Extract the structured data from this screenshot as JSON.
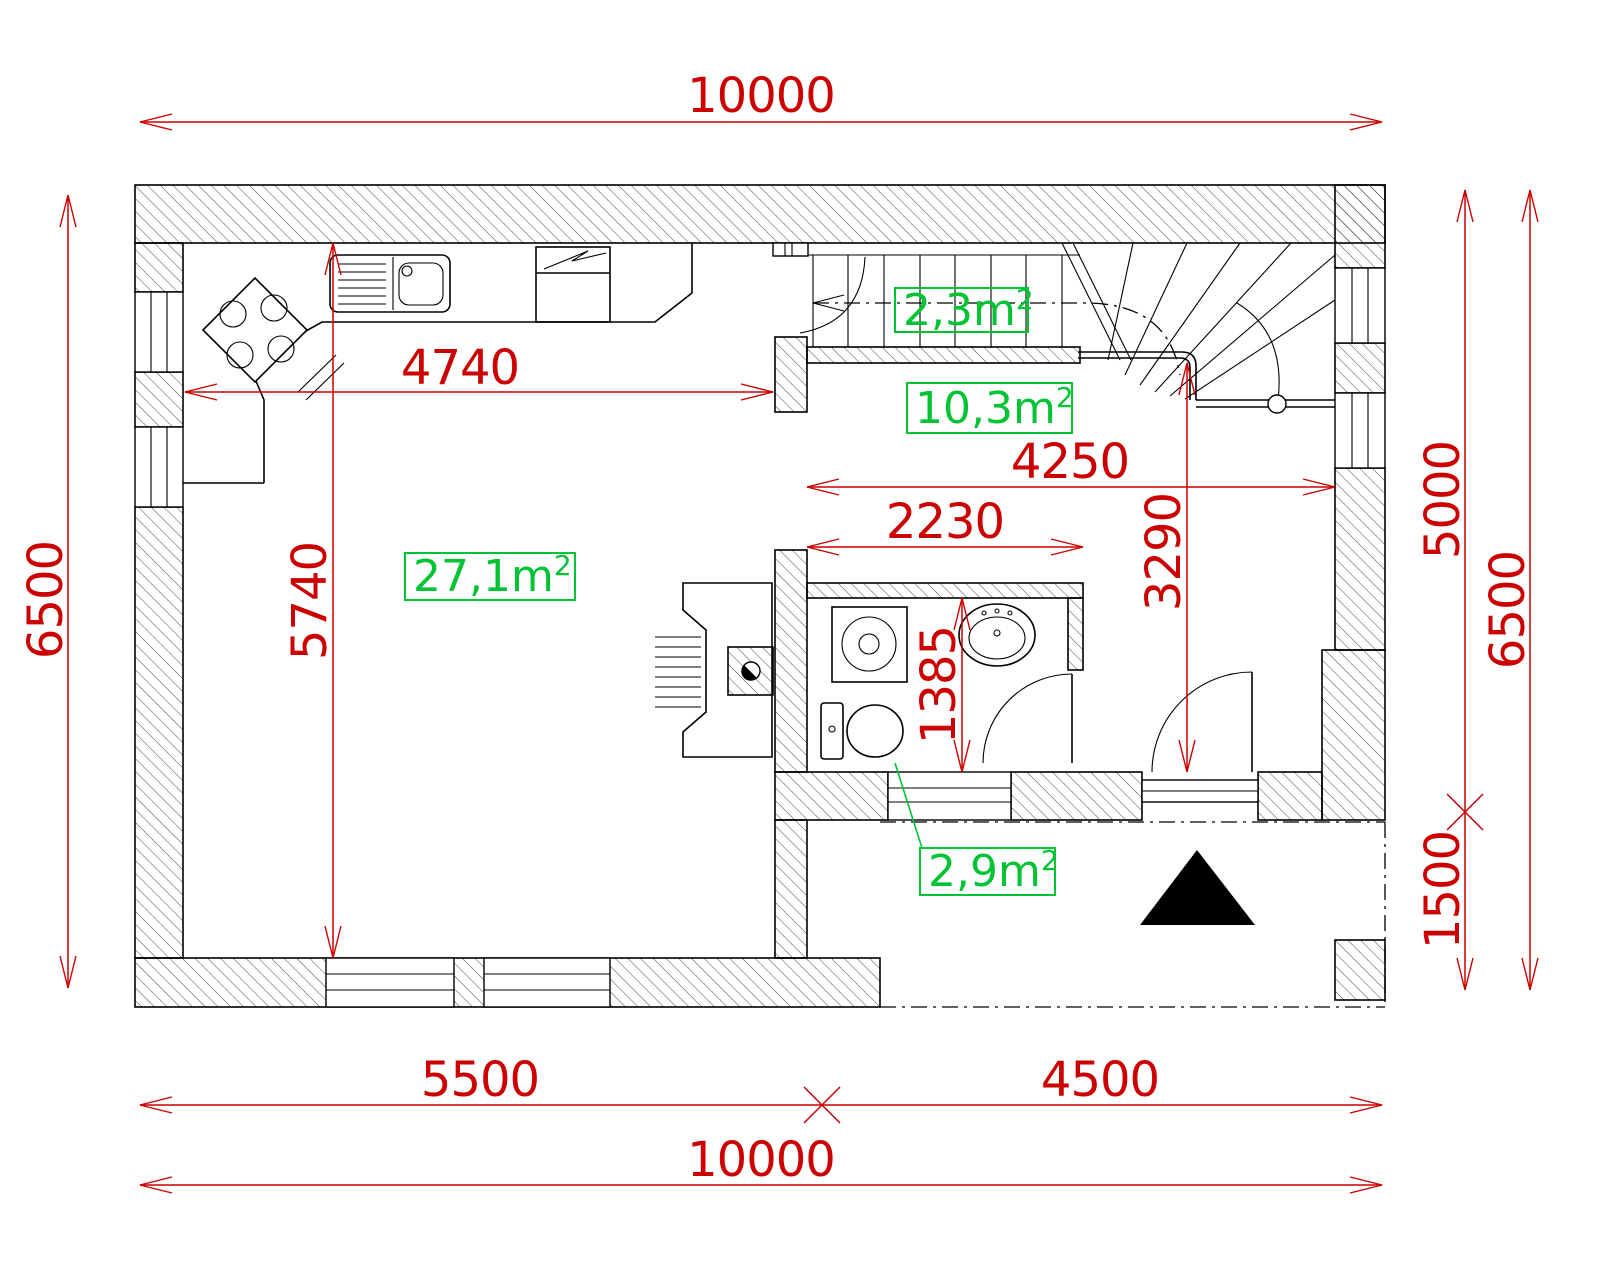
{
  "drawing": {
    "kind": "architectural floor plan",
    "colors": {
      "dimension_red": "#cc0000",
      "area_green": "#00c433",
      "line_black": "#000000",
      "background": "#ffffff"
    },
    "dims": {
      "top_total": "10000",
      "bottom_left": "5500",
      "bottom_right": "4500",
      "bottom_total": "10000",
      "left_total": "6500",
      "right_upper": "5000",
      "right_lower": "1500",
      "right_outer": "6500",
      "kitchen_run": "4740",
      "living_depth": "5740",
      "hall_width": "4250",
      "bath_width": "2230",
      "hall_depth": "3290",
      "bath_depth": "1385"
    },
    "areas": {
      "living_kitchen": {
        "value": "27,1m",
        "sup": "2"
      },
      "under_stairs": {
        "value": "2,3m",
        "sup": "2"
      },
      "hall": {
        "value": "10,3m",
        "sup": "2"
      },
      "bathroom": {
        "value": "2,9m",
        "sup": "2"
      }
    }
  }
}
